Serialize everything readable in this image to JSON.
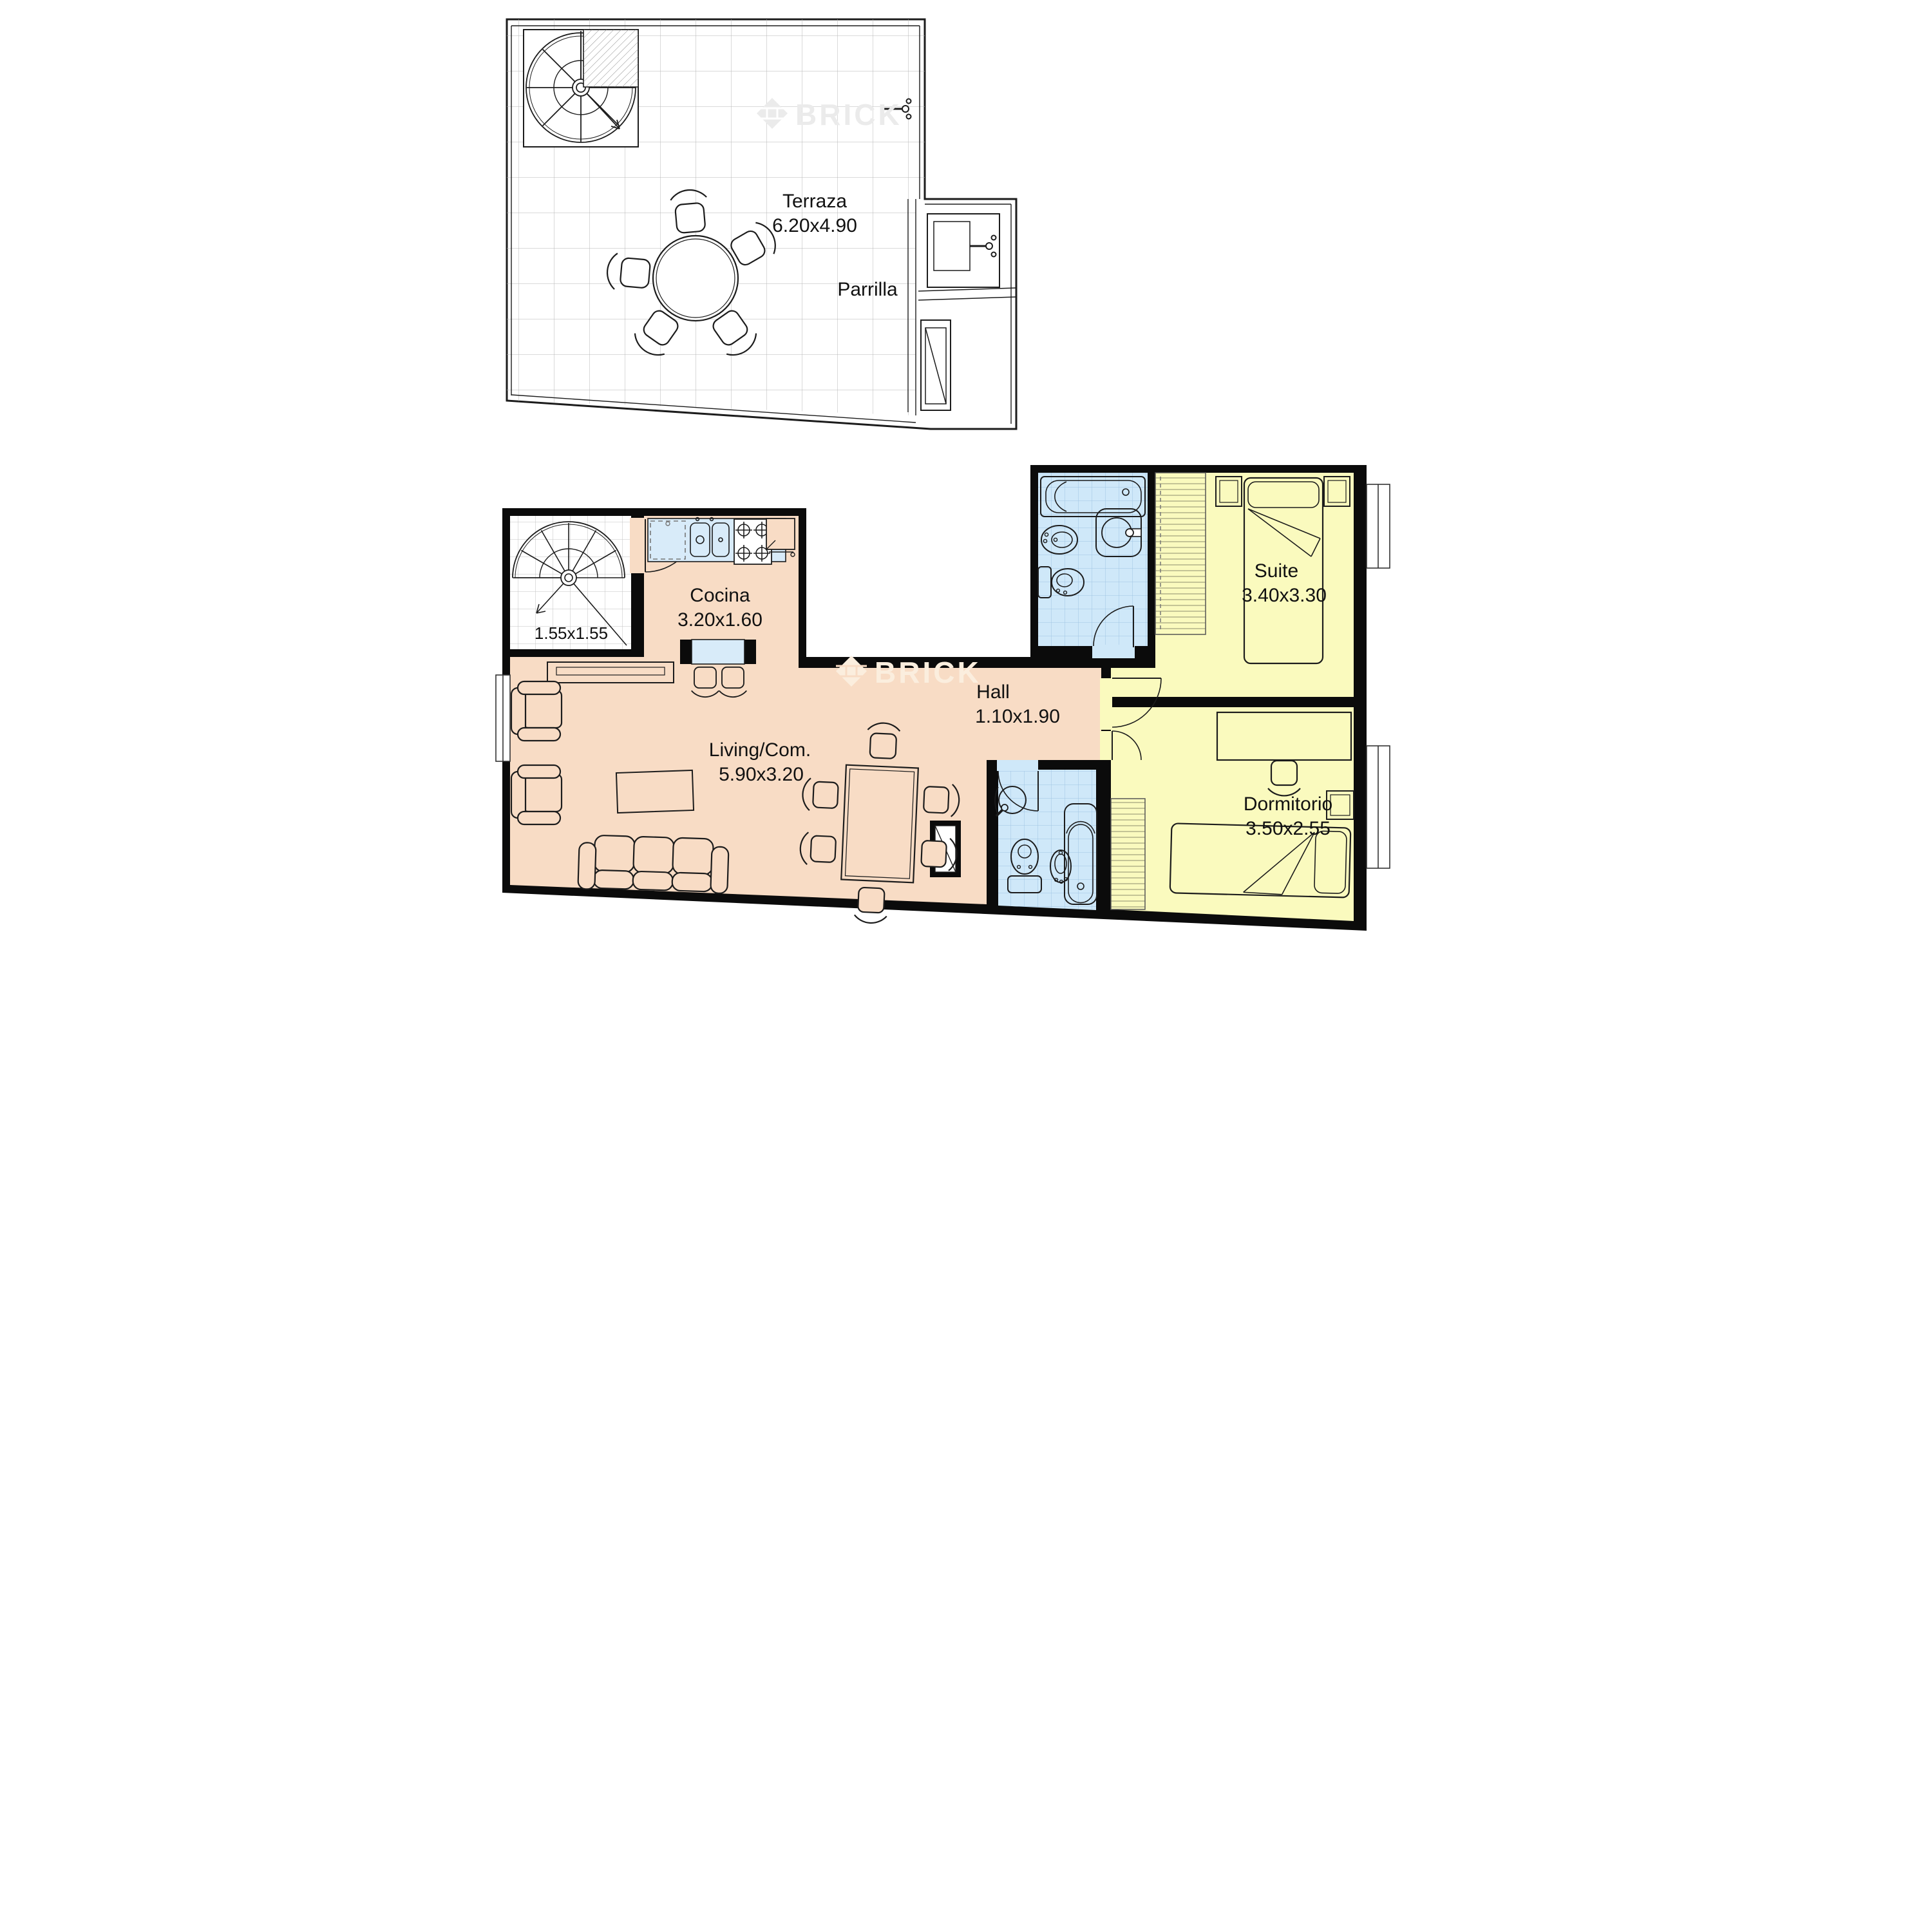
{
  "terrace": {
    "label": "Terraza",
    "dims": "6.20x4.90",
    "parrilla": "Parrilla"
  },
  "apartment": {
    "stairs": {
      "dims": "1.55x1.55"
    },
    "cocina": {
      "label": "Cocina",
      "dims": "3.20x1.60"
    },
    "living": {
      "label": "Living/Com.",
      "dims": "5.90x3.20"
    },
    "hall": {
      "label": "Hall",
      "dims": "1.10x1.90"
    },
    "suite": {
      "label": "Suite",
      "dims": "3.40x3.30"
    },
    "dormitorio": {
      "label": "Dormitorio",
      "dims": "3.50x2.55"
    }
  },
  "watermark": {
    "text": "BRICK"
  },
  "colors": {
    "wall": "#0b0b0b",
    "line": "#1c1c1c",
    "living_floor": "#f8dcc5",
    "bedroom_floor": "#fafabe",
    "bath_tile": "#cfe8f9",
    "counter": "#d8ebf9",
    "watermark_light": "#ebebeb",
    "watermark_cream": "#fbeede"
  }
}
